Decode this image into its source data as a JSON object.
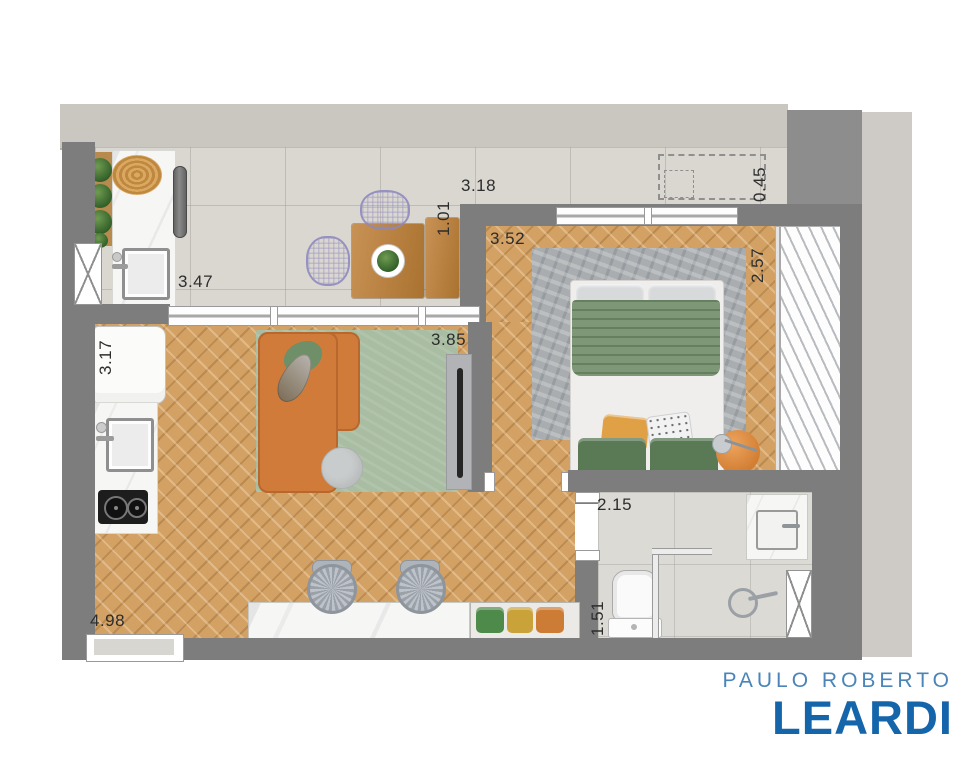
{
  "dimensions": {
    "gourmet_width": "3.47",
    "terrace_width": "3.18",
    "terrace_depth": "1.01",
    "ledge_depth": "0.45",
    "bedroom_width": "3.52",
    "bedroom_depth": "2.57",
    "kitchen_length": "3.17",
    "living_width": "3.85",
    "bathroom_width": "2.15",
    "bathroom_depth": "1.51",
    "living_length": "4.98"
  },
  "logo": {
    "top": "PAULO ROBERTO",
    "name": "LEARDI"
  },
  "palette": {
    "wall": "#7d7d7d",
    "band": "#cac7c1",
    "panel": "#cecbc6",
    "tile": "#dad7d1",
    "wood": "#d3a164",
    "rug_living": "#a8bda2",
    "sofa": "#d07b3a",
    "duvet": "#7e9877",
    "cushion_green": "#4e8a49",
    "cushion_yellow": "#c9a23a",
    "cushion_orange": "#cd7c35",
    "logo_top": "#4a84b8",
    "logo_name": "#1565ab"
  }
}
